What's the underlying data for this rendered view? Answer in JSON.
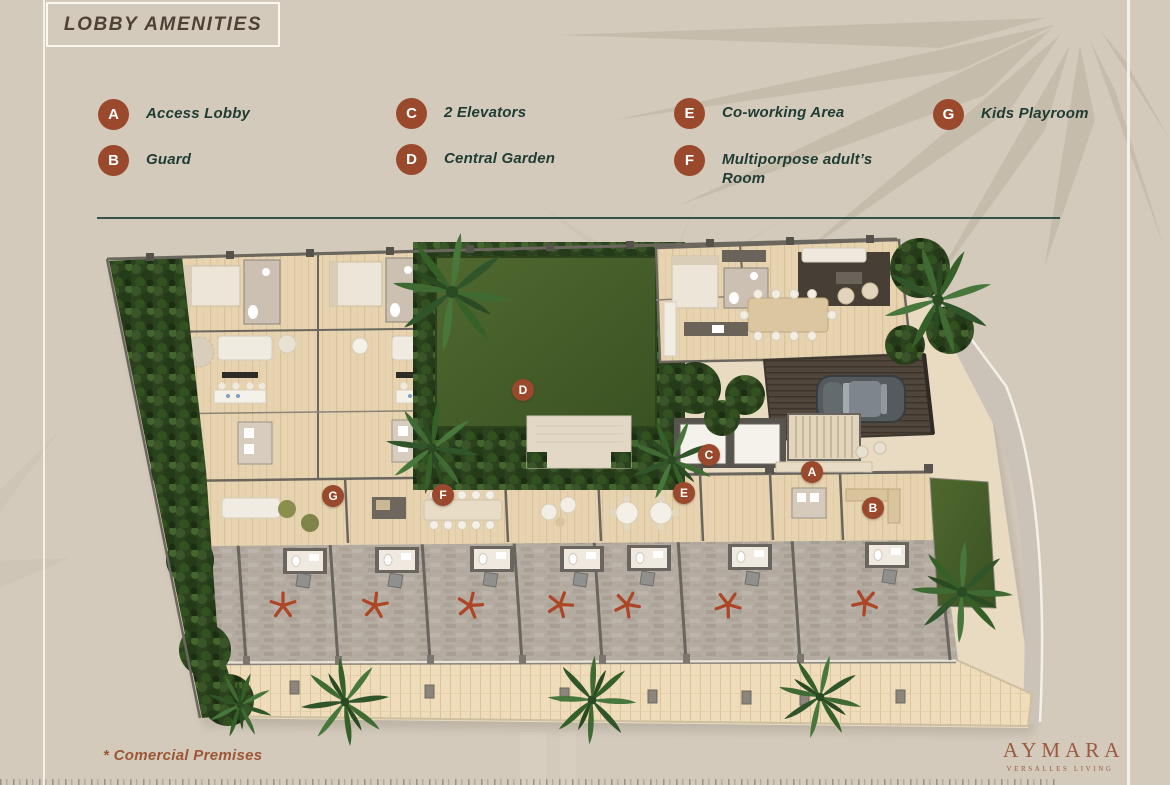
{
  "title": {
    "text": "LOBBY AMENITIES"
  },
  "legend": {
    "items": [
      {
        "letter": "A",
        "label": "Access Lobby"
      },
      {
        "letter": "B",
        "label": "Guard"
      },
      {
        "letter": "C",
        "label": "2 Elevators"
      },
      {
        "letter": "D",
        "label": "Central Garden"
      },
      {
        "letter": "E",
        "label": "Co-working Area"
      },
      {
        "letter": "F",
        "label": "Multiporpose adult’s Room"
      },
      {
        "letter": "G",
        "label": "Kids Playroom"
      }
    ]
  },
  "plan": {
    "markers": [
      {
        "letter": "D",
        "x": 523,
        "y": 390
      },
      {
        "letter": "C",
        "x": 709,
        "y": 455
      },
      {
        "letter": "A",
        "x": 812,
        "y": 472
      },
      {
        "letter": "G",
        "x": 333,
        "y": 496
      },
      {
        "letter": "F",
        "x": 443,
        "y": 495
      },
      {
        "letter": "E",
        "x": 684,
        "y": 493
      },
      {
        "letter": "B",
        "x": 873,
        "y": 508
      }
    ],
    "commercial_stars": [
      {
        "x": 283,
        "y": 608
      },
      {
        "x": 375,
        "y": 608
      },
      {
        "x": 470,
        "y": 608
      },
      {
        "x": 560,
        "y": 607
      },
      {
        "x": 627,
        "y": 607
      },
      {
        "x": 728,
        "y": 607
      },
      {
        "x": 865,
        "y": 605
      }
    ]
  },
  "footnote": {
    "text": "* Comercial Premises"
  },
  "brand": {
    "name": "AYMARA",
    "tagline": "VERSALLES LIVING"
  },
  "colors": {
    "background": "#d3cabc",
    "palm_silhouette": "#c6bcab",
    "badge": "#9a492c",
    "badge_letter": "#ffffff",
    "legend_text": "#1f3c33",
    "title_text": "#4e4136",
    "divider": "#33524a",
    "star": "#ad4527",
    "footnote_text": "#9c5636",
    "brand_text": "#9c5b40",
    "deco_line": "#f6f2ea"
  }
}
